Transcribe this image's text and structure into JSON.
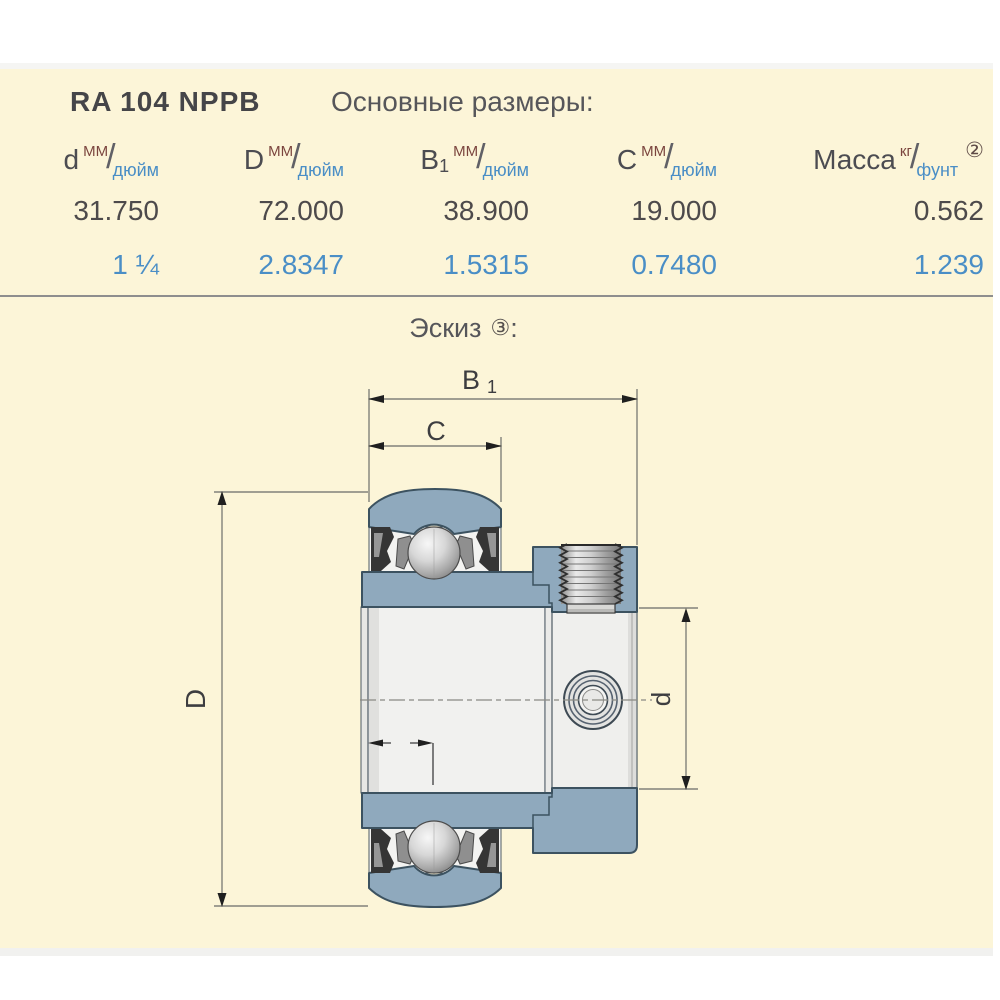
{
  "colors": {
    "panel_bg": "#FCF5D8",
    "steel_blue": "#8FA9BD",
    "drawing_outline": "#3C5260",
    "inch_text_blue": "#4A8EC6",
    "unit_maroon": "#7B453E",
    "separator_gray": "#8E8E8E"
  },
  "header": {
    "part_number": "RA 104 NPPB",
    "section_title": "Основные размеры:"
  },
  "table": {
    "slash": "/",
    "columns": [
      {
        "symbol": "d",
        "sub": "",
        "unit_top": "ММ",
        "unit_bottom": "дюйм",
        "footnote": ""
      },
      {
        "symbol": "D",
        "sub": "",
        "unit_top": "ММ",
        "unit_bottom": "дюйм",
        "footnote": ""
      },
      {
        "symbol": "B",
        "sub": "1",
        "unit_top": "ММ",
        "unit_bottom": "дюйм",
        "footnote": ""
      },
      {
        "symbol": "C",
        "sub": "",
        "unit_top": "ММ",
        "unit_bottom": "дюйм",
        "footnote": ""
      },
      {
        "symbol": "Масса",
        "sub": "",
        "unit_top": "кг",
        "unit_bottom": "фунт",
        "footnote": "②"
      }
    ],
    "row_mm": [
      "31.750",
      "72.000",
      "38.900",
      "19.000",
      "0.562"
    ],
    "row_inch": [
      "1 ¼",
      "2.8347",
      "1.5315",
      "0.7480",
      "1.239"
    ]
  },
  "sketch": {
    "title": "Эскиз",
    "footnote": "③",
    "colon": ":",
    "dims": {
      "B_main": "B",
      "B_sub": "1",
      "C": "C",
      "D": "D",
      "d": "d"
    }
  }
}
